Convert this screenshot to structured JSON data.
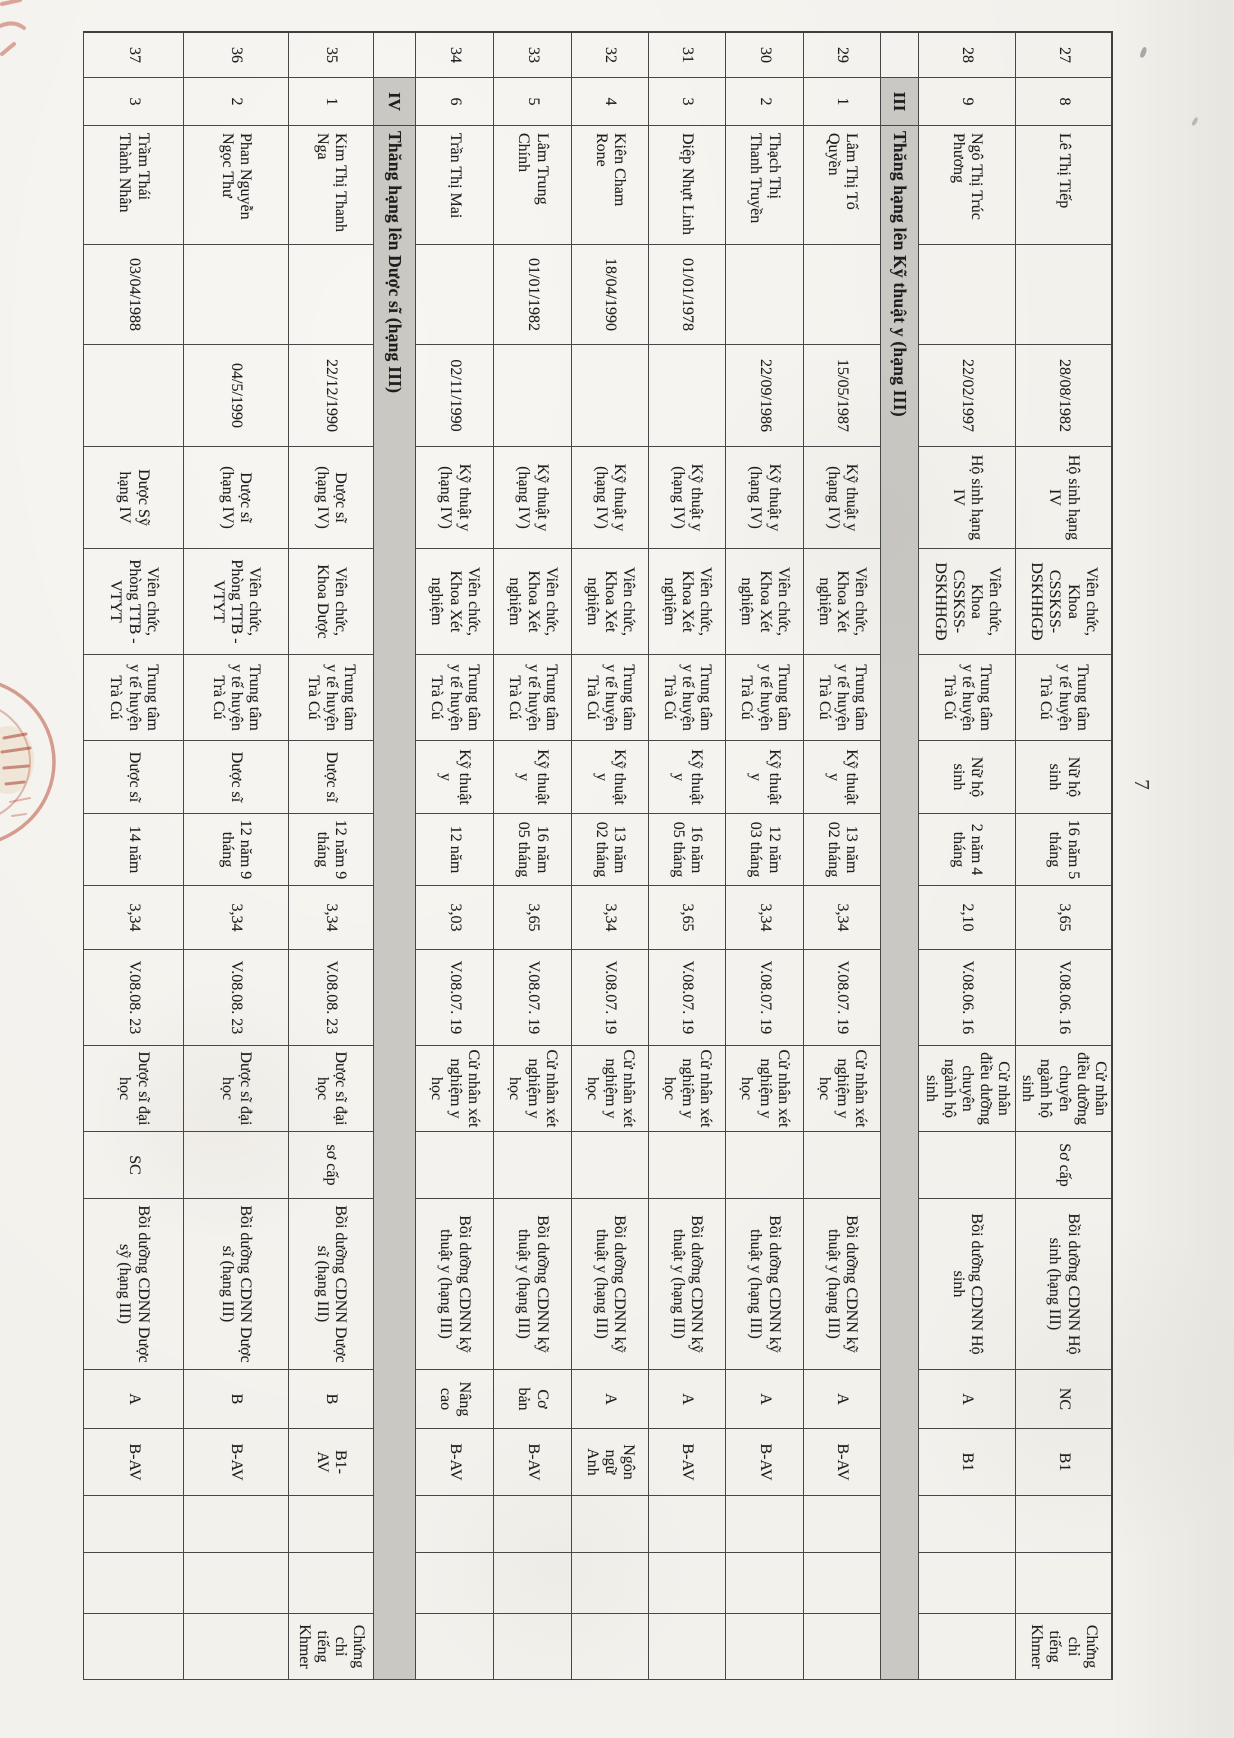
{
  "page": {
    "number": "7"
  },
  "table": {
    "rows": [
      {
        "type": "data",
        "cells": [
          "27",
          "8",
          "Lê Thị Tiếp",
          "",
          "28/08/1982",
          "Hộ sinh hạng IV",
          "Viên chức, Khoa CSSKSS-DSKHHGĐ",
          "Trung tâm y tế huyện Trà Cú",
          "Nữ hộ sinh",
          "16 năm 5 tháng",
          "3,65",
          "V.08.06. 16",
          "Cử nhân điều dưỡng chuyên ngành hộ sinh",
          "Sơ cấp",
          "Bồi dưỡng CDNN Hộ sinh (hạng III)",
          "NC",
          "B1",
          "",
          "",
          "Chứng chỉ tiếng Khmer"
        ]
      },
      {
        "type": "data",
        "cells": [
          "28",
          "9",
          "Ngô Thị Trúc Phương",
          "",
          "22/02/1997",
          "Hộ sinh hạng IV",
          "Viên chức, Khoa CSSKSS-DSKHHGĐ",
          "Trung tâm y tế huyện Trà Cú",
          "Nữ hộ sinh",
          "2 năm 4 tháng",
          "2,10",
          "V.08.06. 16",
          "Cử nhân điều dưỡng chuyên ngành hộ sinh",
          "",
          "Bồi dưỡng CDNN Hộ sinh",
          "A",
          "B1",
          "",
          "",
          ""
        ]
      },
      {
        "type": "section",
        "numeral": "III",
        "label": "Thăng hạng lên Kỹ thuật y (hạng III)"
      },
      {
        "type": "data",
        "cells": [
          "29",
          "1",
          "Lâm Thị Tố Quyền",
          "",
          "15/05/1987",
          "Kỹ thuật y (hạng IV)",
          "Viên chức, Khoa Xét nghiệm",
          "Trung tâm y tế huyện Trà Cú",
          "Kỹ thuật y",
          "13 năm 02 tháng",
          "3,34",
          "V.08.07. 19",
          "Cử nhân xét nghiệm y học",
          "",
          "Bồi dưỡng CDNN kỹ thuật y (hạng III)",
          "A",
          "B-AV",
          "",
          "",
          ""
        ]
      },
      {
        "type": "data",
        "cells": [
          "30",
          "2",
          "Thạch Thị Thanh Truyền",
          "",
          "22/09/1986",
          "Kỹ thuật y (hạng IV)",
          "Viên chức, Khoa Xét nghiệm",
          "Trung tâm y tế huyện Trà Cú",
          "Kỹ thuật y",
          "12 năm 03 tháng",
          "3,34",
          "V.08.07. 19",
          "Cử nhân xét nghiệm y học",
          "",
          "Bồi dưỡng CDNN kỹ thuật y (hạng III)",
          "A",
          "B-AV",
          "",
          "",
          ""
        ]
      },
      {
        "type": "data",
        "cells": [
          "31",
          "3",
          "Diệp Nhựt Linh",
          "01/01/1978",
          "",
          "Kỹ thuật y (hạng IV)",
          "Viên chức, Khoa Xét nghiệm",
          "Trung tâm y tế huyện Trà Cú",
          "Kỹ thuật y",
          "16 năm 05 tháng",
          "3,65",
          "V.08.07. 19",
          "Cử nhân xét nghiệm y học",
          "",
          "Bồi dưỡng CDNN kỹ thuật y (hạng III)",
          "A",
          "B-AV",
          "",
          "",
          ""
        ]
      },
      {
        "type": "data",
        "cells": [
          "32",
          "4",
          "Kiên Cham Rone",
          "18/04/1990",
          "",
          "Kỹ thuật y (hạng IV)",
          "Viên chức, Khoa Xét nghiệm",
          "Trung tâm y tế huyện Trà Cú",
          "Kỹ thuật y",
          "13 năm 02 tháng",
          "3,34",
          "V.08.07. 19",
          "Cử nhân xét nghiệm y học",
          "",
          "Bồi dưỡng CDNN kỹ thuật y (hạng III)",
          "A",
          "Ngôn ngữ Anh",
          "",
          "",
          ""
        ]
      },
      {
        "type": "data",
        "cells": [
          "33",
          "5",
          "Lâm Trung Chính",
          "01/01/1982",
          "",
          "Kỹ thuật y (hạng IV)",
          "Viên chức, Khoa Xét nghiệm",
          "Trung tâm y tế huyện Trà Cú",
          "Kỹ thuật y",
          "16 năm 05 tháng",
          "3,65",
          "V.08.07. 19",
          "Cử nhân xét nghiệm y học",
          "",
          "Bồi dưỡng CDNN kỹ thuật y (hạng III)",
          "Cơ bản",
          "B-AV",
          "",
          "",
          ""
        ]
      },
      {
        "type": "data",
        "cells": [
          "34",
          "6",
          "Trần Thị Mai",
          "",
          "02/11/1990",
          "Kỹ thuật y (hạng IV)",
          "Viên chức, Khoa Xét nghiệm",
          "Trung tâm y tế huyện Trà Cú",
          "Kỹ thuật y",
          "12 năm",
          "3,03",
          "V.08.07. 19",
          "Cử nhân xét nghiệm y học",
          "",
          "Bồi dưỡng CDNN kỹ thuật y (hạng III)",
          "Nâng cao",
          "B-AV",
          "",
          "",
          ""
        ]
      },
      {
        "type": "section",
        "numeral": "IV",
        "label": "Thăng hạng lên Dược sĩ (hạng III)"
      },
      {
        "type": "data",
        "cells": [
          "35",
          "1",
          "Kim Thị Thanh Nga",
          "",
          "22/12/1990",
          "Dược sĩ (hạng IV)",
          "Viên chức, Khoa Dược",
          "Trung tâm y tế huyện Trà Cú",
          "Dược sĩ",
          "12 năm 9 tháng",
          "3,34",
          "V.08.08. 23",
          "Dược sĩ đại học",
          "sơ cấp",
          "Bồi dưỡng CDNN Dược sĩ (hạng III)",
          "B",
          "B1- AV",
          "",
          "",
          "Chứng chỉ tiếng Khmer"
        ]
      },
      {
        "type": "data",
        "cells": [
          "36",
          "2",
          "Phan Nguyễn Ngọc Thư",
          "",
          "04/5/1990",
          "Dược sĩ (hạng IV)",
          "Viên chức, Phòng TTB - VTYT",
          "Trung tâm y tế huyện Trà Cú",
          "Dược sĩ",
          "12 năm 9 tháng",
          "3,34",
          "V.08.08. 23",
          "Dược sĩ đại học",
          "",
          "Bồi dưỡng CDNN Dược sĩ (hạng III)",
          "B",
          "B-AV",
          "",
          "",
          ""
        ]
      },
      {
        "type": "data",
        "cells": [
          "37",
          "3",
          "Trầm Thái Thành Nhân",
          "03/04/1988",
          "",
          "Dược Sỹ hạng IV",
          "Viên chức, Phòng TTB - VTYT",
          "Trung tâm y tế huyện Trà Cú",
          "Dược sĩ",
          "14 năm",
          "3,34",
          "V.08.08. 23",
          "Dược sĩ đại học",
          "SC",
          "Bồi dưỡng CDNN Dược sỹ (hạng III)",
          "A",
          "B-AV",
          "",
          "",
          ""
        ]
      }
    ]
  }
}
